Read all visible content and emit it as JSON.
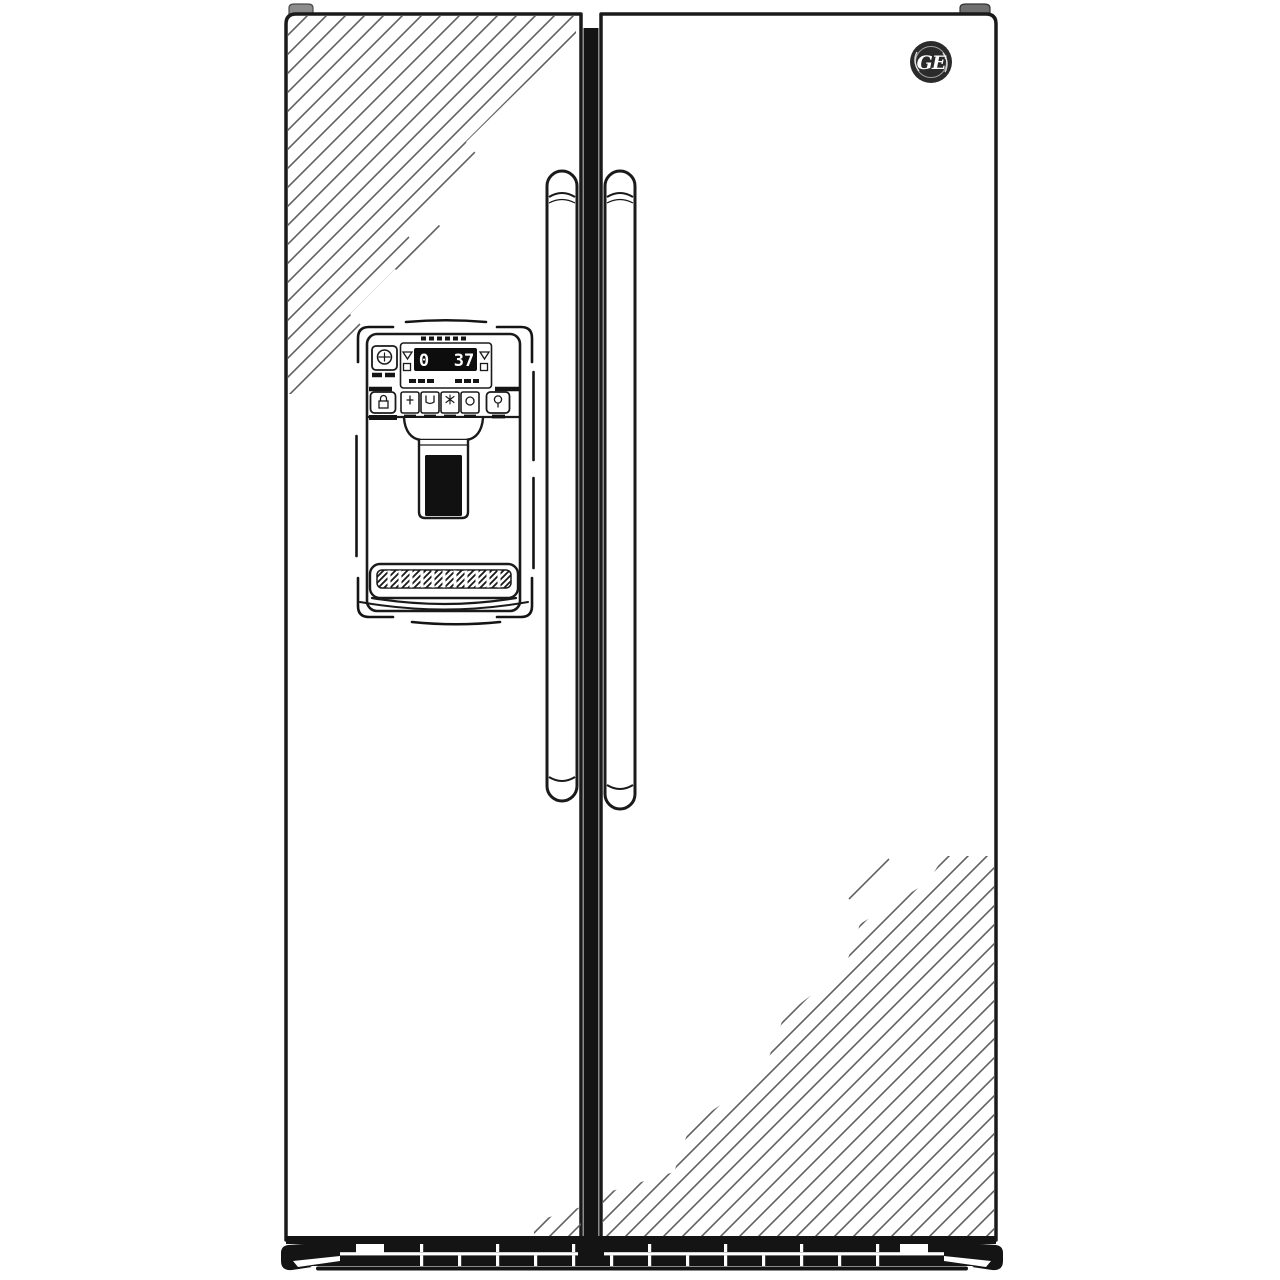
{
  "scene": {
    "title": "GE side-by-side refrigerator — black and white line illustration",
    "background_color": "#ffffff",
    "line_color": "#1a1a1a",
    "hatch_color": "#606060",
    "hinge_cap_color": "#8c8c8c"
  },
  "brand": {
    "monogram": "GE"
  },
  "refrigerator": {
    "style": "side-by-side, two doors, exterior ice/water dispenser on left door",
    "left_door": {
      "features": [
        "dispenser with control panel",
        "diagonal sheen hatching top-left"
      ]
    },
    "right_door": {
      "features": [
        "GE round monogram badge top-left of door",
        "diagonal sheen hatching bottom-right"
      ]
    },
    "handles": {
      "count": 2,
      "orientation": "vertical",
      "position": "center-mounted beside door gap"
    }
  },
  "control_panel": {
    "display": {
      "left_value": "0",
      "right_value": "37",
      "left_adjusters": [
        "up-triangle",
        "square"
      ],
      "right_adjusters": [
        "up-triangle",
        "square"
      ]
    },
    "row1_buttons": 1,
    "row2_buttons": 6
  },
  "dispenser": {
    "paddle": "dark actuator paddle in recessed well",
    "drip_tray_slots": 12
  },
  "kickplate": {
    "vent_slots_lower": 13,
    "vent_slots_upper": 7,
    "end_notches": 2
  }
}
